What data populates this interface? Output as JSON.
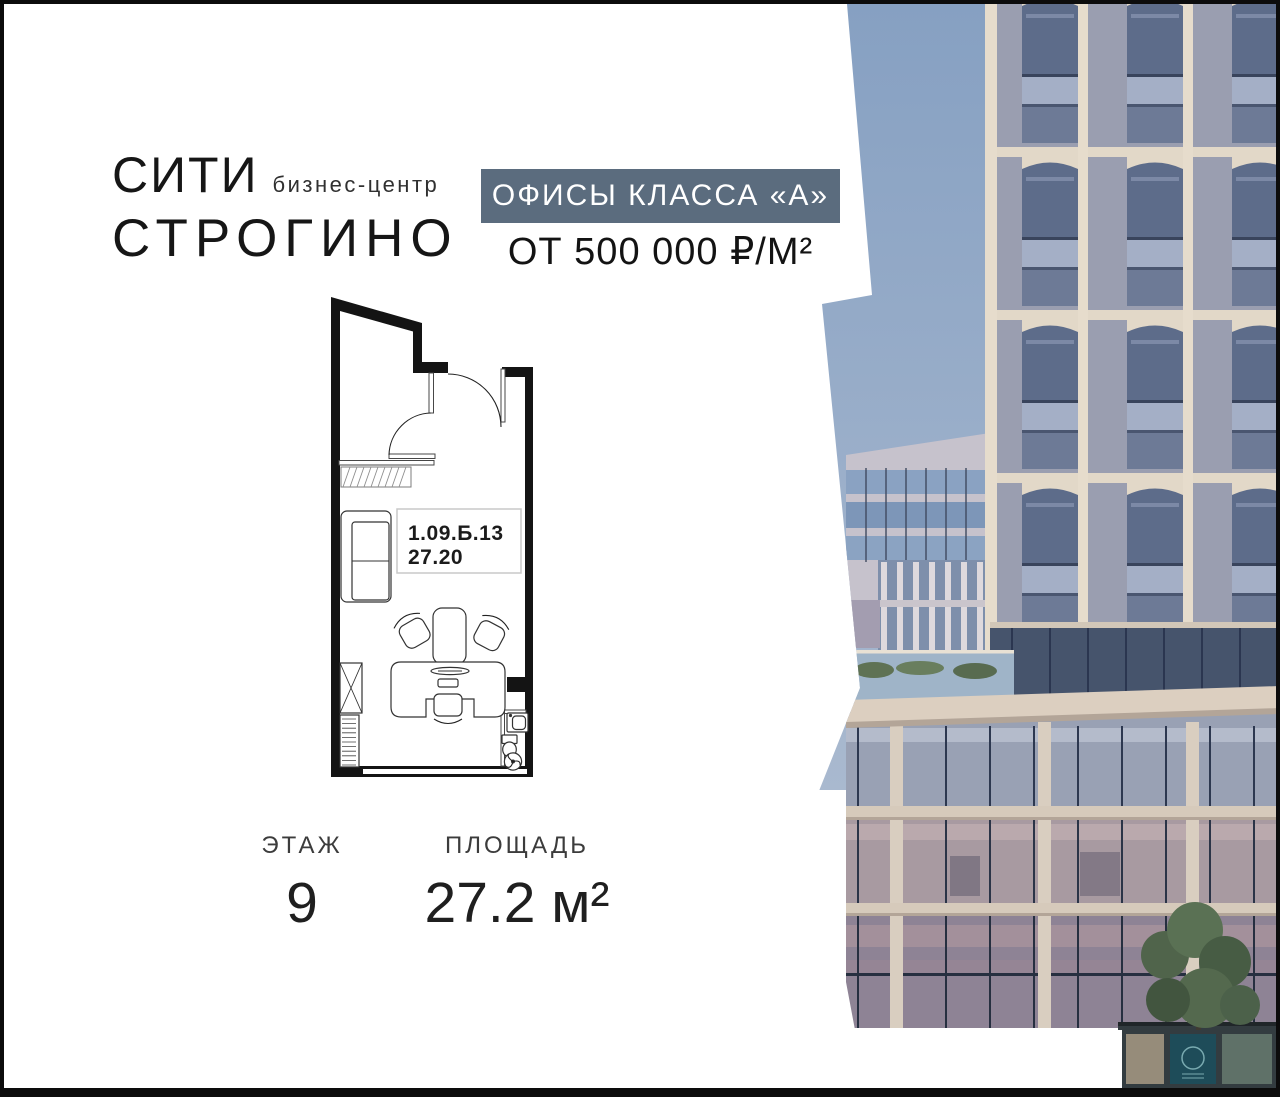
{
  "brand": {
    "name_line1": "СИТИ",
    "subtitle": "бизнес-центр",
    "name_line2": "СТРОГИНО"
  },
  "offer": {
    "badge_label": "ОФИСЫ КЛАССА «А»",
    "price_label": "ОТ 500 000 ₽/М²"
  },
  "floor_plan": {
    "unit_number": "1.09.Б.13",
    "unit_area": "27.20"
  },
  "details": {
    "floor": {
      "label": "ЭТАЖ",
      "value": "9"
    },
    "area": {
      "label": "ПЛОЩАДЬ",
      "value": "27.2 м²"
    }
  },
  "colors": {
    "badge_bg": "#5b6c7e",
    "sky": "#8ca4c3",
    "text_dark": "#141414",
    "plan_wall": "#141414",
    "facade_cream": "#e2d8c8",
    "glass_dark": "#5d6c8a"
  }
}
